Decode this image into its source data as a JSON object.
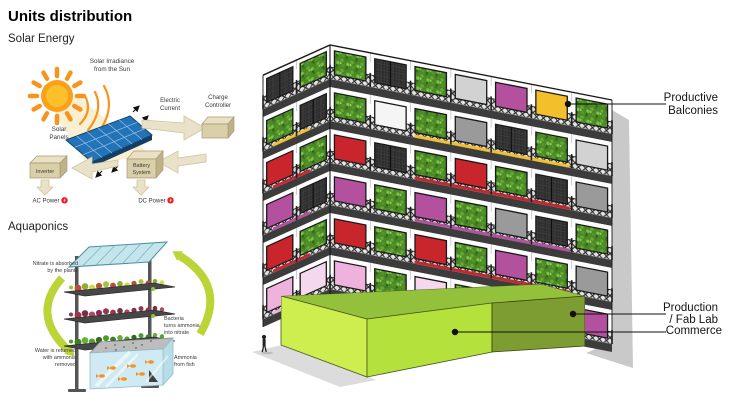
{
  "title": "Units distribution",
  "sections": {
    "solar": "Solar Energy",
    "aqua": "Aquaponics"
  },
  "solar": {
    "labels": {
      "irradiance": [
        "Solar Irradiance",
        "from the Sun"
      ],
      "panels": [
        "Solar",
        "Panels"
      ],
      "electric_current": [
        "Electric",
        "Current"
      ],
      "charge_controller": [
        "Charge",
        "Controller"
      ],
      "battery": [
        "Battery",
        "System"
      ],
      "inverter": "Inverter",
      "ac_power": "AC Power",
      "dc_power": "DC Power"
    },
    "colors": {
      "sun": "#f7941e",
      "panel": "#2273b8",
      "flow_arrow": "#eae2c8",
      "power_badge": "#ed1c24"
    }
  },
  "aqua": {
    "labels": {
      "nitrate": [
        "Nitrate is absorbed",
        "by the plants"
      ],
      "bacteria": [
        "Bacteria",
        "turns ammonia",
        "into nitrate"
      ],
      "water": [
        "Water is returned",
        "with ammonia",
        "removed"
      ],
      "ammonia": [
        "Ammonia",
        "from fish"
      ]
    },
    "colors": {
      "cycle_arrow": "#bcd437",
      "tank_water": "#cfeaf3",
      "fish": "#f6921e"
    }
  },
  "building": {
    "palette": {
      "red": "#c9252c",
      "magenta": "#b3519f",
      "pink": "#eeb2dc",
      "lightpink": "#f6d8ee",
      "yellow": "#f3c02c",
      "gray": "#9a9a9a",
      "lightgray": "#d2d2d2",
      "white": "#f5f5f5",
      "salmon": "#ef7076",
      "vegetation_green": "#4c8a26",
      "screen_dark": "#2d2d2d",
      "slab": "#3c3c3c"
    },
    "floors": [
      {
        "left": [
          "veg",
          "dark"
        ],
        "right": [
          "veg",
          "dark",
          "veg",
          "lightgray",
          "magenta",
          "yellow",
          "veg"
        ],
        "accent": null
      },
      {
        "left": [
          "dark",
          "veg"
        ],
        "right": [
          "veg",
          "white",
          "veg",
          "gray",
          "dark",
          "veg",
          "lightgray"
        ],
        "accent": "yellow"
      },
      {
        "left": [
          "veg",
          "red"
        ],
        "right": [
          "red",
          "dark",
          "veg",
          "red",
          "veg",
          "dark",
          "gray"
        ],
        "accent": "red"
      },
      {
        "left": [
          "dark",
          "magenta"
        ],
        "right": [
          "magenta",
          "veg",
          "magenta",
          "veg",
          "gray",
          "dark",
          "veg"
        ],
        "accent": "magenta"
      },
      {
        "left": [
          "veg",
          "red"
        ],
        "right": [
          "red",
          "veg",
          "red",
          "veg",
          "magenta",
          "veg",
          "gray"
        ],
        "accent": "red"
      },
      {
        "left": [
          "lightpink",
          "pink"
        ],
        "right": [
          "pink",
          "veg",
          "lightpink",
          "veg",
          "salmon",
          "yellow",
          "magenta"
        ],
        "accent": "pink"
      }
    ],
    "podium": {
      "top": "#94c13c",
      "left": "#cdee4e",
      "front_light": "#b5e13d",
      "front_dark": "#7d9c31"
    }
  },
  "building_labels": {
    "productive": [
      "Productive",
      "Balconies"
    ],
    "production": [
      "Production",
      "/ Fab Lab"
    ],
    "commerce": "Commerce"
  }
}
